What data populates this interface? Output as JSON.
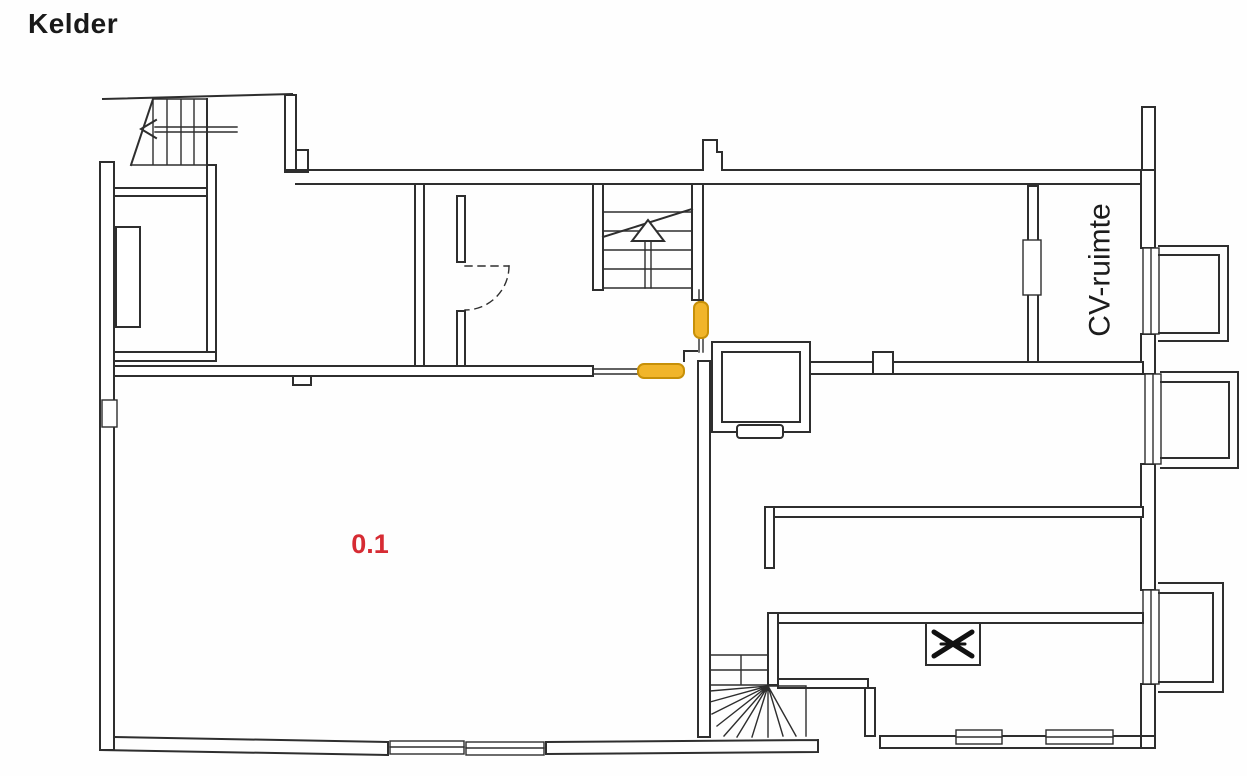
{
  "page": {
    "title": "Kelder"
  },
  "floorplan": {
    "labels": {
      "main_room": "0.1",
      "cv_room": "CV-ruimte"
    },
    "colors": {
      "wall": "#2e2e2e",
      "door_highlight_fill": "#f1b52a",
      "door_highlight_stroke": "#c79008",
      "main_room_label": "#d62b33",
      "cv_room_label": "#1c1c1c"
    },
    "symbols": [
      "straight-stairs-with-up-arrow",
      "straight-stairs-with-left-arrow",
      "winder-stairs",
      "dashed-door-swing",
      "highlighted-door-vertical",
      "highlighted-door-horizontal",
      "elevator-shaft",
      "ventilation-cross",
      "bay-window",
      "window"
    ]
  }
}
